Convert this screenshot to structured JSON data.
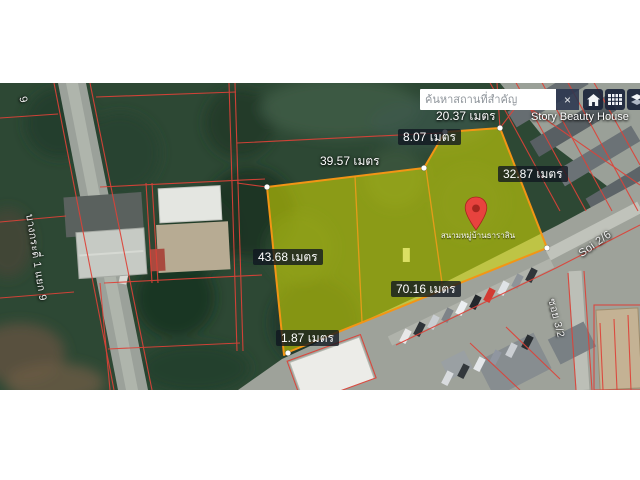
{
  "search": {
    "placeholder": "ค้นหาสถานที่สำคัญ",
    "close_label": "×",
    "buttons": [
      {
        "icon": "home-icon"
      },
      {
        "icon": "grid-icon"
      },
      {
        "icon": "layers-icon"
      }
    ]
  },
  "map": {
    "unit": "เมตร",
    "measurements": [
      {
        "text": "20.37 เมตร",
        "boxed": false
      },
      {
        "text": "8.07 เมตร",
        "boxed": true
      },
      {
        "text": "39.57 เมตร",
        "boxed": false
      },
      {
        "text": "32.87 เมตร",
        "boxed": true
      },
      {
        "text": "43.68 เมตร",
        "boxed": true
      },
      {
        "text": "70.16 เมตร",
        "boxed": true
      },
      {
        "text": "1.87 เมตร",
        "boxed": true
      }
    ],
    "places": [
      {
        "text": "Story Beauty House"
      },
      {
        "text": "สนามหมู่บ้านธาราสิน"
      }
    ],
    "roads": [
      {
        "text": "บางกระดี่ 1 แยก 9"
      },
      {
        "text": "9"
      },
      {
        "text": "Soi 2/6"
      },
      {
        "text": "ซอย 3/2"
      }
    ],
    "colors": {
      "plot_fill": "#d8e000",
      "plot_stroke": "#f39515",
      "parcel_line": "#dd4238",
      "pin": "#e8433e",
      "label_box_bg": "rgba(16,22,32,0.78)"
    }
  }
}
